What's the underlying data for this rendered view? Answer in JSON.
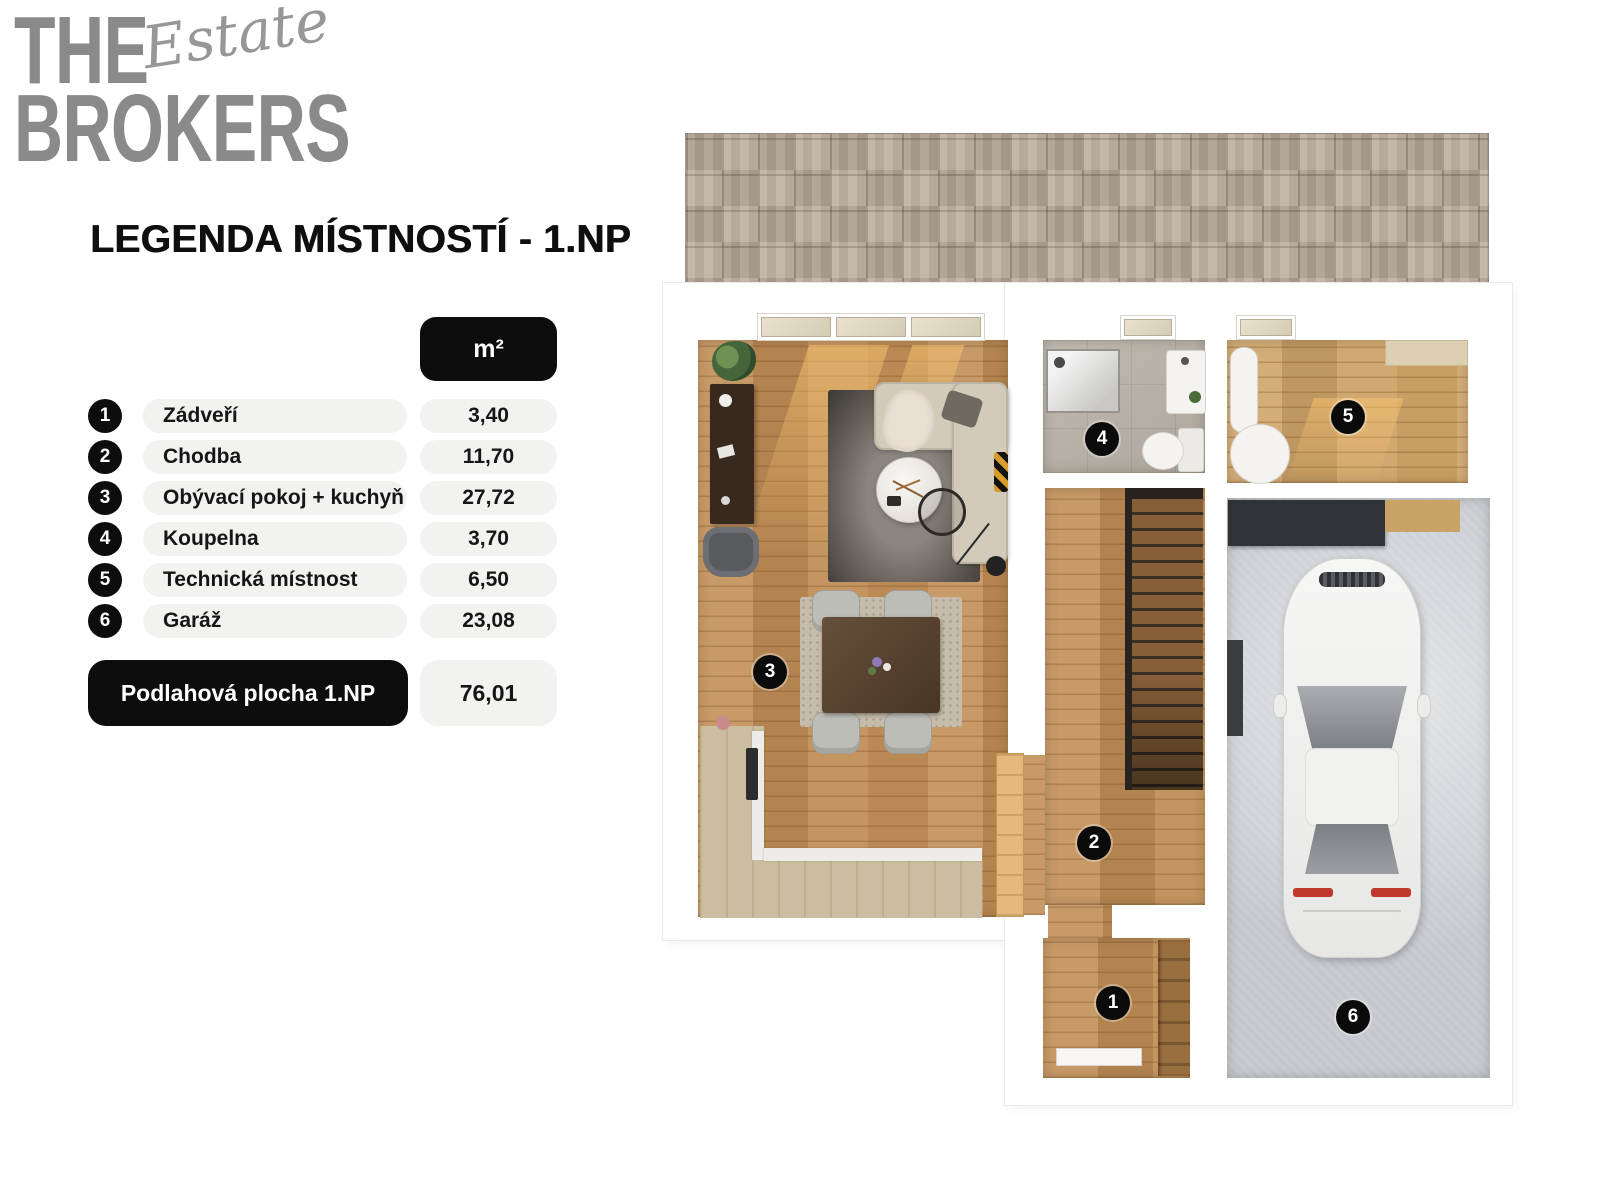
{
  "colors": {
    "ink": "#0d0d0d",
    "pill_bg": "#f2f2f0",
    "logo_gray": "#8a8a8a",
    "wood": "#c28f57",
    "wood_light": "#cfa468",
    "greige": "#cbbd9f",
    "tile": "#b7b0a5",
    "garage_floor": "#c9cdd2",
    "patio": "#b8ab99",
    "stair_wood": "#855f38",
    "sofa": "#d2cbba",
    "taillight_red": "#c0392b"
  },
  "logo": {
    "line1": "THE",
    "line2": "BROKERS",
    "script": "Estate"
  },
  "heading": "LEGENDA MÍSTNOSTÍ - 1.NP",
  "legend": {
    "unit": "m²",
    "rows": [
      {
        "num": "1",
        "name": "Zádveří",
        "area": "3,40"
      },
      {
        "num": "2",
        "name": "Chodba",
        "area": "11,70"
      },
      {
        "num": "3",
        "name": "Obývací pokoj + kuchyň",
        "area": "27,72"
      },
      {
        "num": "4",
        "name": "Koupelna",
        "area": "3,70"
      },
      {
        "num": "5",
        "name": "Technická místnost",
        "area": "6,50"
      },
      {
        "num": "6",
        "name": "Garáž",
        "area": "23,08"
      }
    ],
    "total_label": "Podlahová plocha 1.NP",
    "total_area": "76,01"
  },
  "plan": {
    "badges": [
      "1",
      "2",
      "3",
      "4",
      "5",
      "6"
    ]
  }
}
